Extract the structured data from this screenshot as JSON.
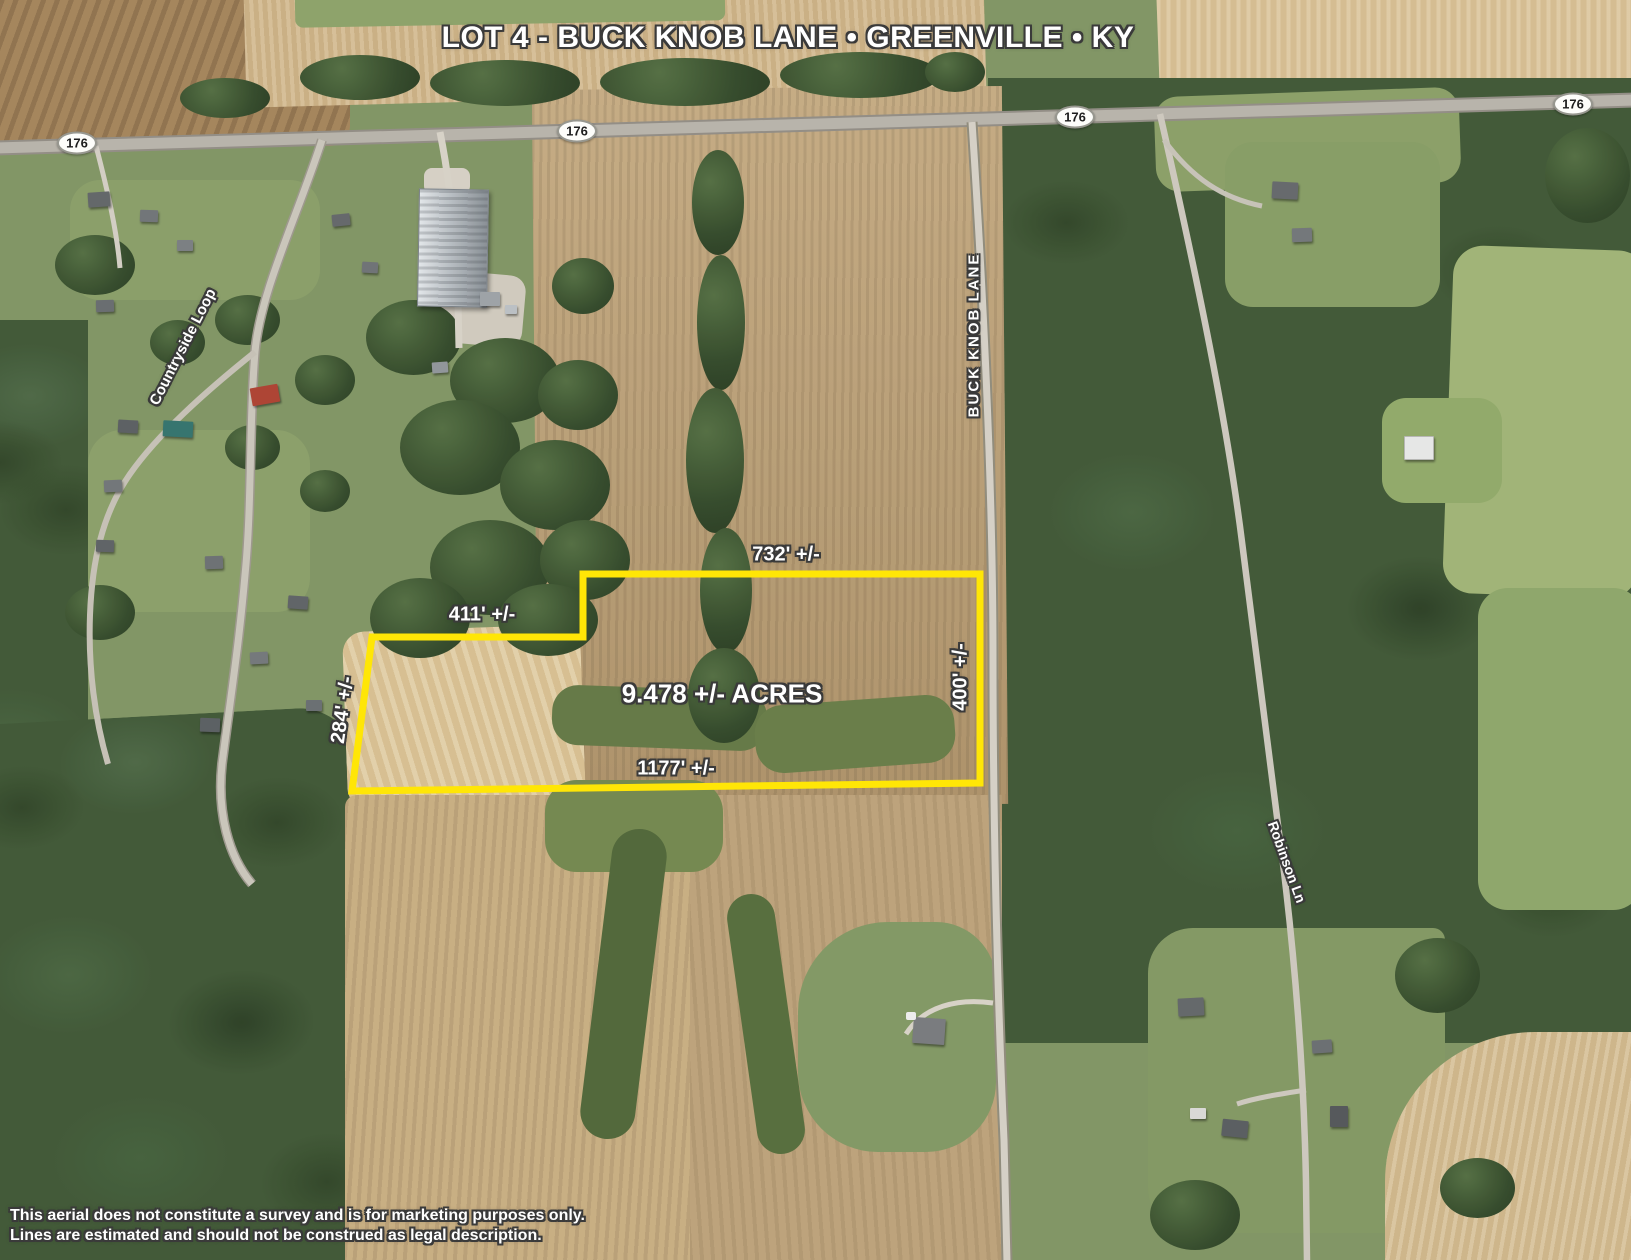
{
  "title": "LOT 4 - BUCK KNOB LANE • GREENVILLE • KY",
  "map": {
    "route_shield_label": "176",
    "road_labels": {
      "countryside_loop": "Countryside Loop",
      "buck_knob_lane": "BUCK KNOB LANE",
      "robinson_lane": "Robinson Ln"
    },
    "parcel": {
      "acreage": "9.478 +/- ACRES",
      "boundary_color": "#FFE606",
      "dimensions": {
        "north": "732' +/-",
        "northwest": "411' +/-",
        "west": "284' +/-",
        "south": "1177' +/-",
        "east": "400' +/-"
      }
    }
  },
  "disclaimer": {
    "line1": "This aerial does not constitute a survey and is for marketing purposes only.",
    "line2": "Lines are estimated and should not be construed as legal description."
  }
}
